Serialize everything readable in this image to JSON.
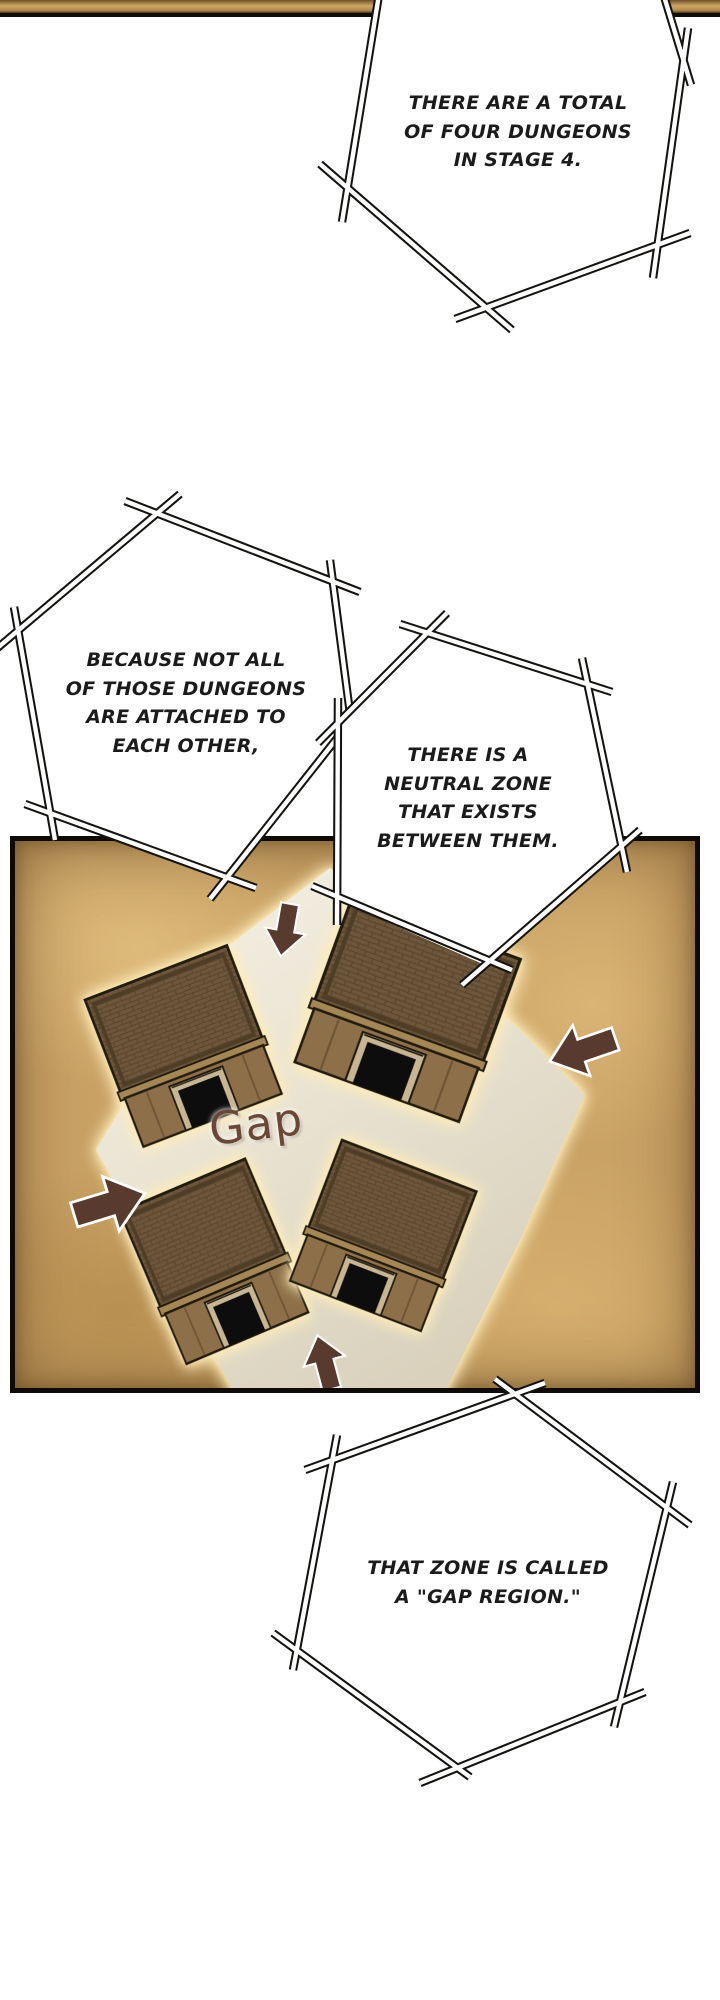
{
  "bubbles": [
    {
      "name": "bubble-1",
      "lines": [
        "THERE ARE A TOTAL",
        "OF FOUR DUNGEONS",
        "IN STAGE 4."
      ]
    },
    {
      "name": "bubble-2",
      "lines": [
        "BECAUSE NOT ALL",
        "OF THOSE DUNGEONS",
        "ARE ATTACHED TO",
        "EACH OTHER,"
      ]
    },
    {
      "name": "bubble-3",
      "lines": [
        "THERE IS A",
        "NEUTRAL ZONE",
        "THAT EXISTS",
        "BETWEEN THEM."
      ]
    },
    {
      "name": "bubble-4",
      "lines": [
        "THAT ZONE IS CALLED",
        "A \"GAP REGION.\""
      ]
    }
  ],
  "panel": {
    "gap_label": "Gap",
    "buildings_count": "4",
    "arrows": [
      "down",
      "left",
      "right",
      "up"
    ]
  },
  "colors": {
    "panel_background": "#c9a266",
    "gap_floor": "#eae3d2",
    "building_brown": "#6e5639",
    "arrow_brown": "#583a2e",
    "gap_label_color": "#6b4737",
    "glow": "#ffe7a6",
    "bubble_outline": "#151310"
  }
}
